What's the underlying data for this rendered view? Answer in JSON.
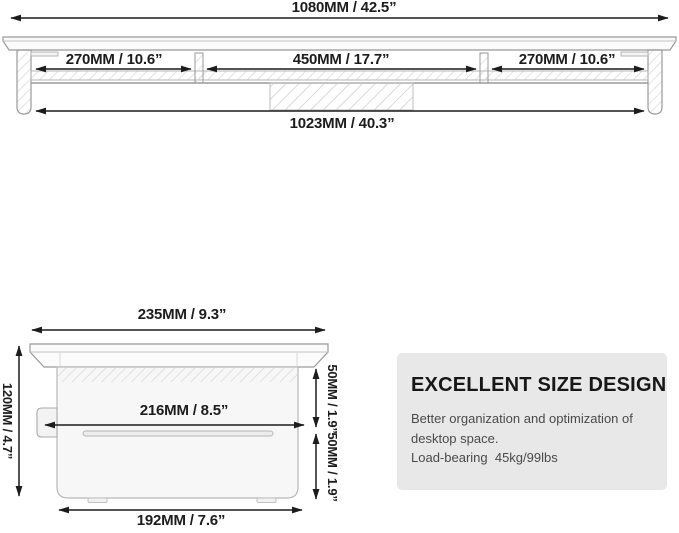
{
  "top_view": {
    "overall_width_label": "1080MM / 42.5”",
    "left_section_label": "270MM / 10.6”",
    "center_section_label": "450MM / 17.7”",
    "right_section_label": "270MM / 10.6”",
    "inner_width_label": "1023MM / 40.3”"
  },
  "side_view": {
    "top_depth_label": "235MM / 9.3”",
    "height_label": "120MM / 4.7”",
    "inner_depth_label": "216MM / 8.5”",
    "upper_gap_label": "50MM / 1.9”",
    "lower_gap_label": "50MM / 1.9”",
    "base_depth_label": "192MM / 7.6”"
  },
  "info_panel": {
    "title": "EXCELLENT SIZE DESIGN",
    "line1": "Better organization and optimization of",
    "line2": "desktop space.",
    "line3": "Load-bearing  45kg/99lbs"
  },
  "colors": {
    "ink": "#1c1c1c",
    "outline": "#9a9a9a",
    "fill_light": "#f7f7f7",
    "hatch": "#d6d6d6",
    "panel_bg": "#e9e8e8",
    "panel_text": "#4a4a4a"
  }
}
